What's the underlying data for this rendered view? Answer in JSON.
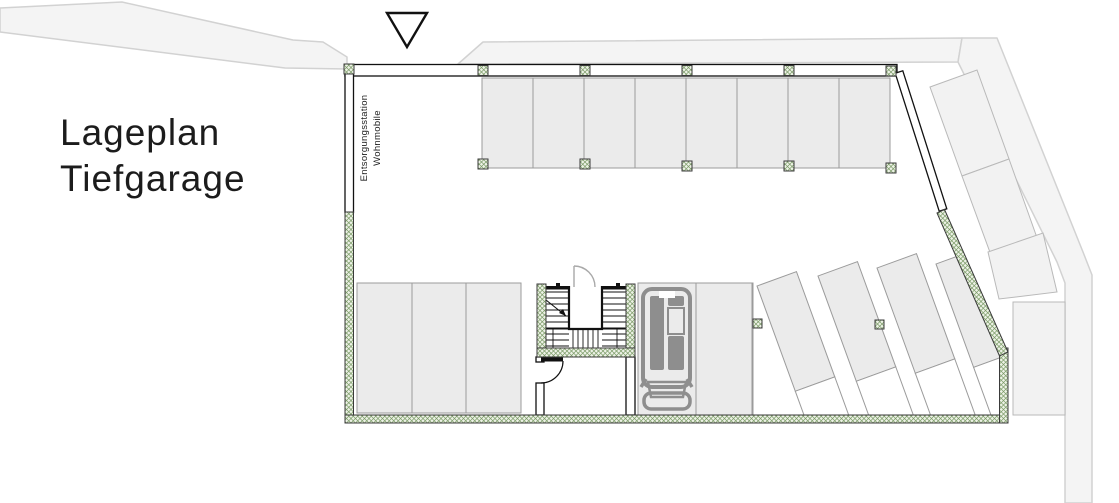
{
  "title": {
    "line1": "Lageplan",
    "line2": "Tiefgarage"
  },
  "annotations": {
    "disposal_station": {
      "line1": "Entsorgungsstation",
      "line2": "Wohnmobile"
    }
  },
  "markers": {
    "entrance_triangle": "entrance-direction-marker"
  },
  "parking": {
    "top_row_spaces": 8,
    "bottom_left_spaces": 3,
    "center_spaces": 2,
    "center_spaces_occupied_by_motorhome": 1,
    "angled_spaces": 4,
    "outside_angled_spaces": 3,
    "outside_straight_spaces": 1
  },
  "colors": {
    "ink": "#1c1c1c",
    "line_ink": "#111111",
    "road_fill": "#f4f4f4",
    "road_stroke": "#d2d2d2",
    "outside_fill": "#f2f2f2",
    "outside_stroke": "#b9b9b9",
    "floor_fill": "#ffffff",
    "parking_fill": "#ebebeb",
    "parking_stroke": "#9b9b9b",
    "wall_green": "#7a9a66",
    "wall_bg": "#edf2e6",
    "wall_outline": "#3a3a3a",
    "car_gray": "#8e8e8e",
    "door_gray": "#a9a9a9"
  }
}
